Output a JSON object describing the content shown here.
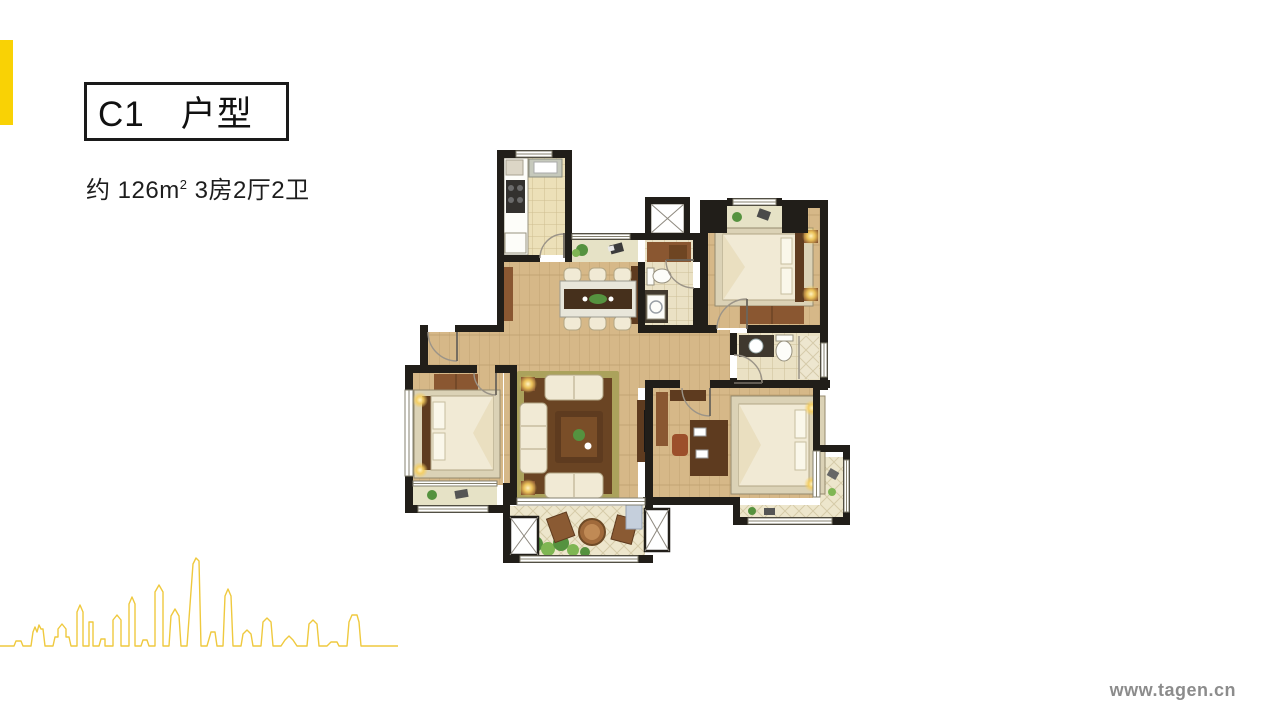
{
  "colors": {
    "accent": "#F9D205",
    "skyline": "#EFC93E",
    "wall": "#211E19",
    "wood": "#D6B888",
    "tile-kitchen": "#ECE0B8",
    "tile-bath": "#EAE1C4",
    "tile-balcony": "#EDE6CC",
    "bay": "#E6E2C6",
    "rug-border": "#ABA25C",
    "rug-center": "#6A4423",
    "furn-cream": "#F1EAD5",
    "furn-brown": "#8A5731",
    "furn-darkbrown": "#5E3B1F",
    "plant": "#55923F",
    "text": "#1A1A1A",
    "watermark": "#8C8C8C"
  },
  "header": {
    "title": "C1　户型",
    "area": {
      "pre": "约 126m",
      "sup": "2",
      "post": " 3房2厅2卫"
    }
  },
  "footer": {
    "watermark": "www.tagen.cn"
  }
}
